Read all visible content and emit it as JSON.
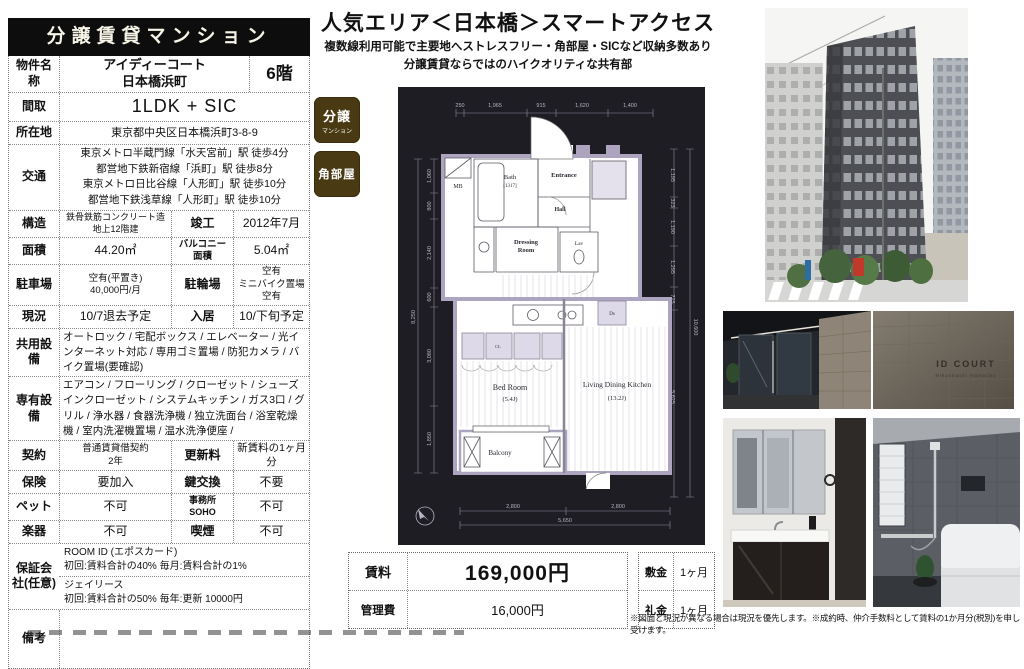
{
  "header": {
    "title": "分譲賃貸マンション"
  },
  "property_table": {
    "rows": [
      {
        "label": "物件名称",
        "cells": [
          {
            "t": "アイディーコート\n日本橋浜町"
          },
          {
            "t": "6階"
          }
        ]
      },
      {
        "label": "間取",
        "cells": [
          {
            "t": "1LDK + SIC"
          }
        ]
      },
      {
        "label": "所在地",
        "cells": [
          {
            "t": "東京都中央区日本橋浜町3-8-9"
          }
        ]
      },
      {
        "label": "交通",
        "cells": [
          {
            "t": "東京メトロ半蔵門線「水天宮前」駅 徒歩4分\n都営地下鉄新宿線「浜町」駅 徒歩8分\n東京メトロ日比谷線「人形町」駅 徒歩10分\n都営地下鉄浅草線「人形町」駅 徒歩10分"
          }
        ]
      },
      {
        "label": "構造",
        "cells": [
          {
            "t": "鉄骨鉄筋コンクリート造\n地上12階建"
          },
          {
            "t": "竣工"
          },
          {
            "t": "2012年7月"
          }
        ]
      },
      {
        "label": "面積",
        "cells": [
          {
            "t": "44.20㎡"
          },
          {
            "t": "バルコニー\n面積"
          },
          {
            "t": "5.04㎡"
          }
        ]
      },
      {
        "label": "駐車場",
        "cells": [
          {
            "t": "空有(平置き)\n40,000円/月"
          },
          {
            "t": "駐輪場"
          },
          {
            "t": "空有\nミニバイク置場空有"
          }
        ]
      },
      {
        "label": "現況",
        "cells": [
          {
            "t": "10/7退去予定"
          },
          {
            "t": "入居"
          },
          {
            "t": "10/下旬予定"
          }
        ]
      },
      {
        "label": "共用設備",
        "cells": [
          {
            "t": "オートロック / 宅配ボックス / エレベーター / 光インターネット対応 / 専用ゴミ置場 / 防犯カメラ / バイク置場(要確認)"
          }
        ]
      },
      {
        "label": "専有設備",
        "cells": [
          {
            "t": "エアコン / フローリング / クローゼット / シューズインクローゼット / システムキッチン / ガス3口 / グリル / 浄水器 / 食器洗浄機 / 独立洗面台 / 浴室乾燥機 / 室内洗濯機置場 / 温水洗浄便座 /"
          }
        ]
      },
      {
        "label": "契約",
        "cells": [
          {
            "t": "普通賃貸借契約\n2年"
          },
          {
            "t": "更新料"
          },
          {
            "t": "新賃料の1ヶ月分"
          }
        ]
      },
      {
        "label": "保険",
        "cells": [
          {
            "t": "要加入"
          },
          {
            "t": "鍵交換"
          },
          {
            "t": "不要"
          }
        ]
      },
      {
        "label": "ペット",
        "cells": [
          {
            "t": "不可"
          },
          {
            "t": "事務所\nSOHO"
          },
          {
            "t": "不可"
          }
        ]
      },
      {
        "label": "楽器",
        "cells": [
          {
            "t": "不可"
          },
          {
            "t": "喫煙"
          },
          {
            "t": "不可"
          }
        ]
      },
      {
        "label": "保証会社(任意)",
        "cells": [
          {
            "t": "ROOM ID (エポスカード)\n初回:賃料合計の40%  毎月:賃料合計の1%"
          },
          {
            "t": "ジェイリース\n初回:賃料合計の50%  毎年:更新 10000円"
          }
        ]
      },
      {
        "label": "備考",
        "cells": [
          {
            "t": ""
          }
        ]
      }
    ]
  },
  "main": {
    "title": "人気エリア＜日本橋＞スマートアクセス",
    "subtitle1": "複数線利用可能で主要地へストレスフリー・角部屋・SICなど収納多数あり",
    "subtitle2": "分譲賃貸ならではのハイクオリティな共有部",
    "badges": [
      {
        "main": "分譲",
        "sub": "マンション"
      },
      {
        "main": "角部屋",
        "sub": ""
      }
    ],
    "badge_color": "#4a3a14",
    "disclaimer": "※図面と現況が異なる場合は現況を優先します。※成約時、仲介手数料として賃料の1か月分(税別)を申し受けます。"
  },
  "price_table": {
    "rows": [
      {
        "label": "賃料",
        "value": "169,000円",
        "label2": "敷金",
        "value2": "1ヶ月"
      },
      {
        "label": "管理費",
        "value": "16,000円",
        "label2": "礼金",
        "value2": "1ヶ月"
      }
    ]
  },
  "fp": {
    "rooms": {
      "mb": "MB",
      "bath": "Bath",
      "bath_size": "[1317]",
      "entrance": "Entrance",
      "hall": "Hall",
      "dressing1": "Dressing",
      "dressing2": "Room",
      "lav": "Lav",
      "ds": "Ds",
      "cl": "CL",
      "bed": "Bed Room",
      "bed_size": "(5.4J)",
      "ldk": "Living Dining Kitchen",
      "ldk_size": "(13.2J)",
      "balcony": "Balcony"
    },
    "dims": {
      "t1": "250",
      "t2": "1,965",
      "t3": "915",
      "t4": "1,620",
      "t5": "1,400",
      "l1": "1,060",
      "l2": "800",
      "l3": "2,140",
      "l4": "600",
      "l5": "3,080",
      "l6": "1,850",
      "l7": "8,250",
      "r1": "1,195",
      "r2": "323",
      "r3": "1,190",
      "r4": "1,295",
      "r5": "725",
      "r6": "5,825",
      "r7": "10,600",
      "b1": "2,800",
      "b2": "2,800",
      "b3": "5,650"
    }
  },
  "photos": {
    "sign_line1": "ID COURT",
    "sign_line2": "Nihonbashi Hamacho"
  }
}
